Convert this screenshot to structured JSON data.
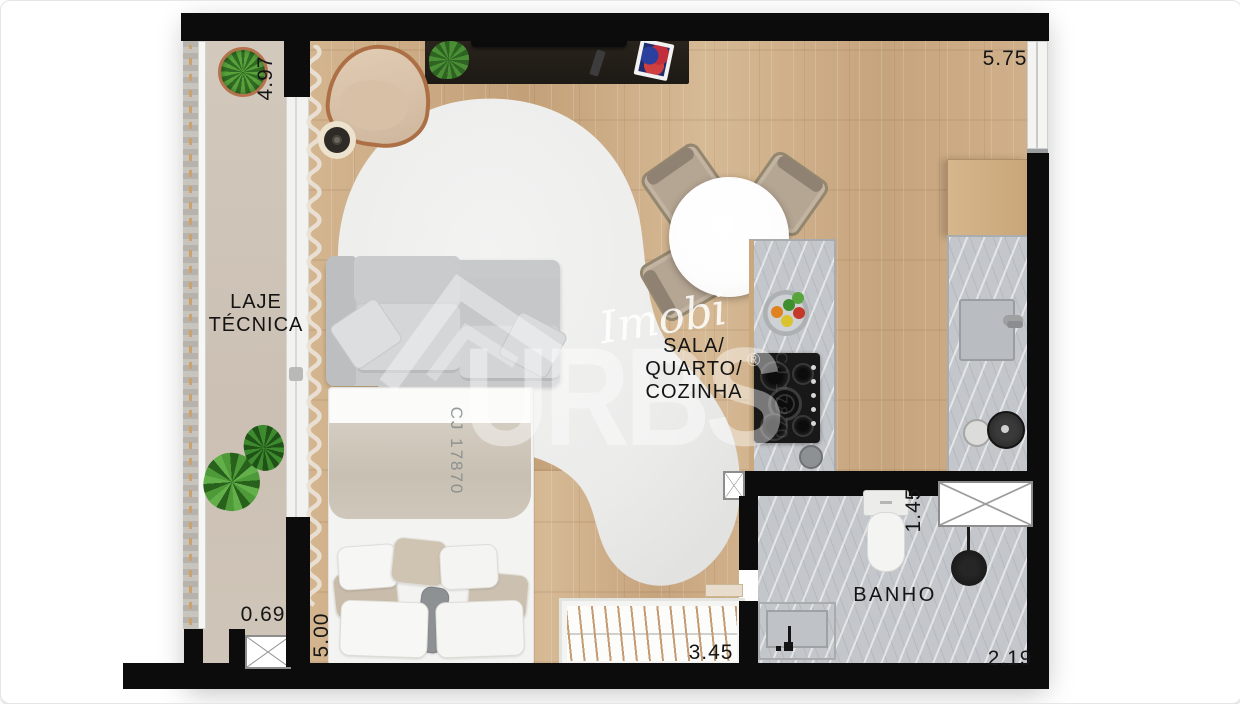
{
  "floorplan": {
    "rooms": {
      "laje_tecnica": {
        "lines": [
          "LAJE",
          "TÉCNICA"
        ]
      },
      "sala_quarto_cozinha": {
        "lines": [
          "SALA/",
          "QUARTO/",
          "COZINHA"
        ]
      },
      "banho": {
        "label": "BANHO"
      }
    },
    "dimensions": {
      "laje_depth": "4.97",
      "sala_width": "5.75",
      "laje_bottom_width": "0.69",
      "sala_depth": "5.00",
      "closet_width": "3.45",
      "banho_depth": "1.45",
      "banho_width": "2.19"
    },
    "watermark": {
      "brand_script": "Imobi",
      "brand_name": "URBS",
      "registered_mark": "®",
      "listing_code": "CJ 17870"
    },
    "colors": {
      "wall": "#0c0c0c",
      "wood_floor": "#ccab85",
      "laje_floor": "#cfc5b8",
      "marble": "#c3c6ca",
      "rug": "#ececeb",
      "copper_accent": "#ad6f45",
      "plant_green": "#4e9a38"
    }
  }
}
